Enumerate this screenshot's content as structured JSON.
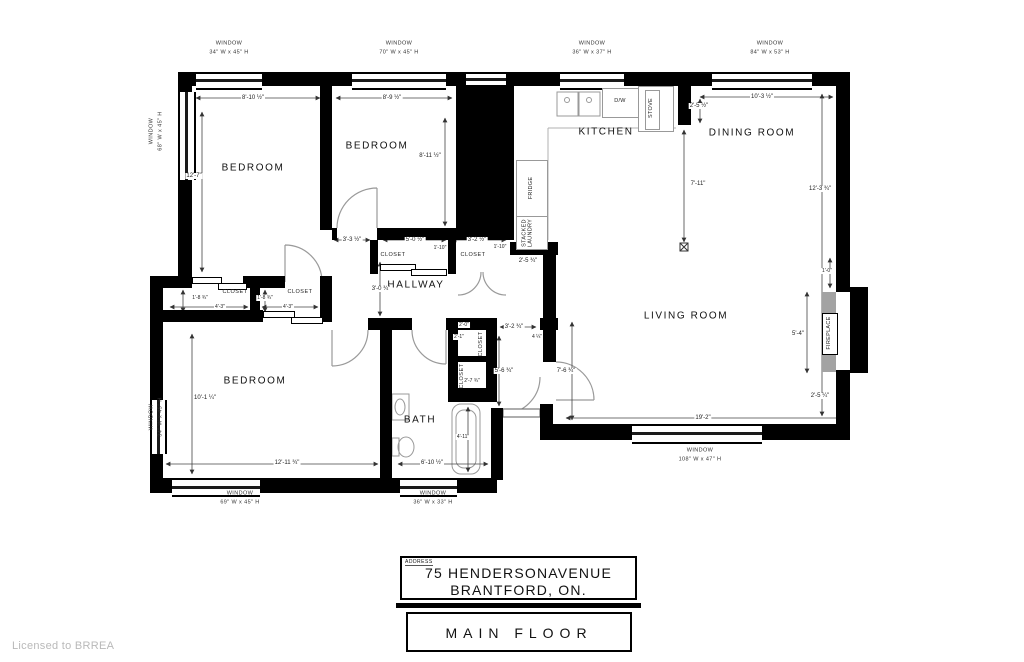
{
  "footer": {
    "address_label": "ADDRESS",
    "address_line1": "75 HENDERSONAVENUE",
    "address_line2": "BRANTFORD, ON.",
    "floor_label": "MAIN FLOOR",
    "license": "Licensed to BRREA"
  },
  "colors": {
    "walls": "#000000",
    "fireplace_gray": "#a3a3a3",
    "license_gray": "#b9b9b9"
  },
  "plan": {
    "rooms": [
      {
        "label": "BEDROOM",
        "x": 253,
        "y": 168
      },
      {
        "label": "BEDROOM",
        "x": 377,
        "y": 146
      },
      {
        "label": "KITCHEN",
        "x": 606,
        "y": 132
      },
      {
        "label": "DINING ROOM",
        "x": 752,
        "y": 133
      },
      {
        "label": "LIVING ROOM",
        "x": 686,
        "y": 316
      },
      {
        "label": "HALLWAY",
        "x": 416,
        "y": 285
      },
      {
        "label": "BEDROOM",
        "x": 255,
        "y": 381
      },
      {
        "label": "BATH",
        "x": 420,
        "y": 420
      }
    ],
    "closets": [
      {
        "label": "CLOSET",
        "x": 235,
        "y": 292,
        "rot": 0
      },
      {
        "label": "CLOSET",
        "x": 300,
        "y": 292,
        "rot": 0
      },
      {
        "label": "CLOSET",
        "x": 393,
        "y": 255,
        "rot": 0
      },
      {
        "label": "CLOSET",
        "x": 473,
        "y": 255,
        "rot": 0
      },
      {
        "label": "CLOSET",
        "x": 481,
        "y": 344,
        "rot": 1
      },
      {
        "label": "CLOSET",
        "x": 462,
        "y": 376,
        "rot": 1
      }
    ],
    "fixtures": [
      {
        "label": "FRIDGE",
        "x": 531,
        "y": 188,
        "rot": 1
      },
      {
        "label": "STACKED",
        "label2": "LAUNDRY",
        "x": 528,
        "y": 233,
        "rot": 1
      },
      {
        "label": "D/W",
        "x": 620,
        "y": 101,
        "rot": 0
      },
      {
        "label": "STOVE",
        "x": 651,
        "y": 108,
        "rot": 1
      },
      {
        "label": "FIREPLACE",
        "x": 829,
        "y": 333,
        "rot": 1
      }
    ],
    "windows": [
      {
        "label": "WINDOW",
        "size": "34\" W x 45\" H",
        "x": 229,
        "y": 49,
        "rot": 0
      },
      {
        "label": "WINDOW",
        "size": "70\" W x 45\" H",
        "x": 399,
        "y": 49,
        "rot": 0
      },
      {
        "label": "WINDOW",
        "size": "36\" W x 37\" H",
        "x": 592,
        "y": 49,
        "rot": 0
      },
      {
        "label": "WINDOW",
        "size": "84\" W x 53\" H",
        "x": 770,
        "y": 49,
        "rot": 0
      },
      {
        "label": "WINDOW",
        "size": "68\" W x 45\" H",
        "x": 157,
        "y": 131,
        "rot": 1
      },
      {
        "label": "WINDOW",
        "size": "34\" W x 45\" H",
        "x": 157,
        "y": 417,
        "rot": 1
      },
      {
        "label": "WINDOW",
        "size": "69\" W x 45\" H",
        "x": 240,
        "y": 499,
        "rot": 0
      },
      {
        "label": "WINDOW",
        "size": "36\" W x 33\" H",
        "x": 433,
        "y": 499,
        "rot": 0
      },
      {
        "label": "WINDOW",
        "size": "108\" W x 47\" H",
        "x": 700,
        "y": 456,
        "rot": 0
      }
    ],
    "dimensions": [
      {
        "text": "8'-10 ½\"",
        "x": 253,
        "y": 98,
        "size": "n"
      },
      {
        "text": "8'-9 ½\"",
        "x": 392,
        "y": 98,
        "size": "n"
      },
      {
        "text": "12'-7\"",
        "x": 194,
        "y": 176,
        "size": "n"
      },
      {
        "text": "8'-11 ½\"",
        "x": 430,
        "y": 156,
        "size": "n"
      },
      {
        "text": "2'-5 ½\"",
        "x": 699,
        "y": 106,
        "size": "n"
      },
      {
        "text": "10'-3 ½\"",
        "x": 762,
        "y": 97,
        "size": "n"
      },
      {
        "text": "7'-11\"",
        "x": 698,
        "y": 184,
        "size": "n"
      },
      {
        "text": "12'-3 ¾\"",
        "x": 820,
        "y": 189,
        "size": "n"
      },
      {
        "text": "3'-3 ½\"",
        "x": 352,
        "y": 240,
        "size": "n"
      },
      {
        "text": "5'-0 ½\"",
        "x": 415,
        "y": 240,
        "size": "n"
      },
      {
        "text": "1'-10\"",
        "x": 440,
        "y": 248,
        "size": "t"
      },
      {
        "text": "3'-2 ½\"",
        "x": 477,
        "y": 240,
        "size": "n"
      },
      {
        "text": "1'-10\"",
        "x": 500,
        "y": 247,
        "size": "t"
      },
      {
        "text": "2'-5 ¾\"",
        "x": 528,
        "y": 261,
        "size": "n"
      },
      {
        "text": "1'-8 ¾\"",
        "x": 200,
        "y": 298,
        "size": "t"
      },
      {
        "text": "4'-3\"",
        "x": 220,
        "y": 307,
        "size": "t"
      },
      {
        "text": "1'-8 ¾\"",
        "x": 265,
        "y": 298,
        "size": "t"
      },
      {
        "text": "4'-3\"",
        "x": 288,
        "y": 307,
        "size": "t"
      },
      {
        "text": "3'-0 ¾\"",
        "x": 381,
        "y": 289,
        "size": "n"
      },
      {
        "text": "2'-0\"",
        "x": 464,
        "y": 325,
        "size": "t"
      },
      {
        "text": "2'-1\"",
        "x": 459,
        "y": 337,
        "size": "t"
      },
      {
        "text": "2'-7 ¾\"",
        "x": 472,
        "y": 381,
        "size": "t"
      },
      {
        "text": "3'-2 ¾\"",
        "x": 514,
        "y": 327,
        "size": "n"
      },
      {
        "text": "4 ¼\"",
        "x": 537,
        "y": 337,
        "size": "t"
      },
      {
        "text": "5'-6 ¾\"",
        "x": 504,
        "y": 371,
        "size": "n"
      },
      {
        "text": "7'-6 ¾\"",
        "x": 566,
        "y": 371,
        "size": "n"
      },
      {
        "text": "19'-2\"",
        "x": 703,
        "y": 418,
        "size": "n"
      },
      {
        "text": "2'-5 ¼\"",
        "x": 820,
        "y": 396,
        "size": "n"
      },
      {
        "text": "5'-4\"",
        "x": 798,
        "y": 334,
        "size": "n"
      },
      {
        "text": "1'-0\"",
        "x": 827,
        "y": 271,
        "size": "t"
      },
      {
        "text": "10'-1 ¼\"",
        "x": 205,
        "y": 398,
        "size": "n"
      },
      {
        "text": "12'-11 ¾\"",
        "x": 287,
        "y": 463,
        "size": "n"
      },
      {
        "text": "6'-10 ½\"",
        "x": 432,
        "y": 463,
        "size": "n"
      },
      {
        "text": "4'-11\"",
        "x": 463,
        "y": 437,
        "size": "t"
      }
    ]
  }
}
